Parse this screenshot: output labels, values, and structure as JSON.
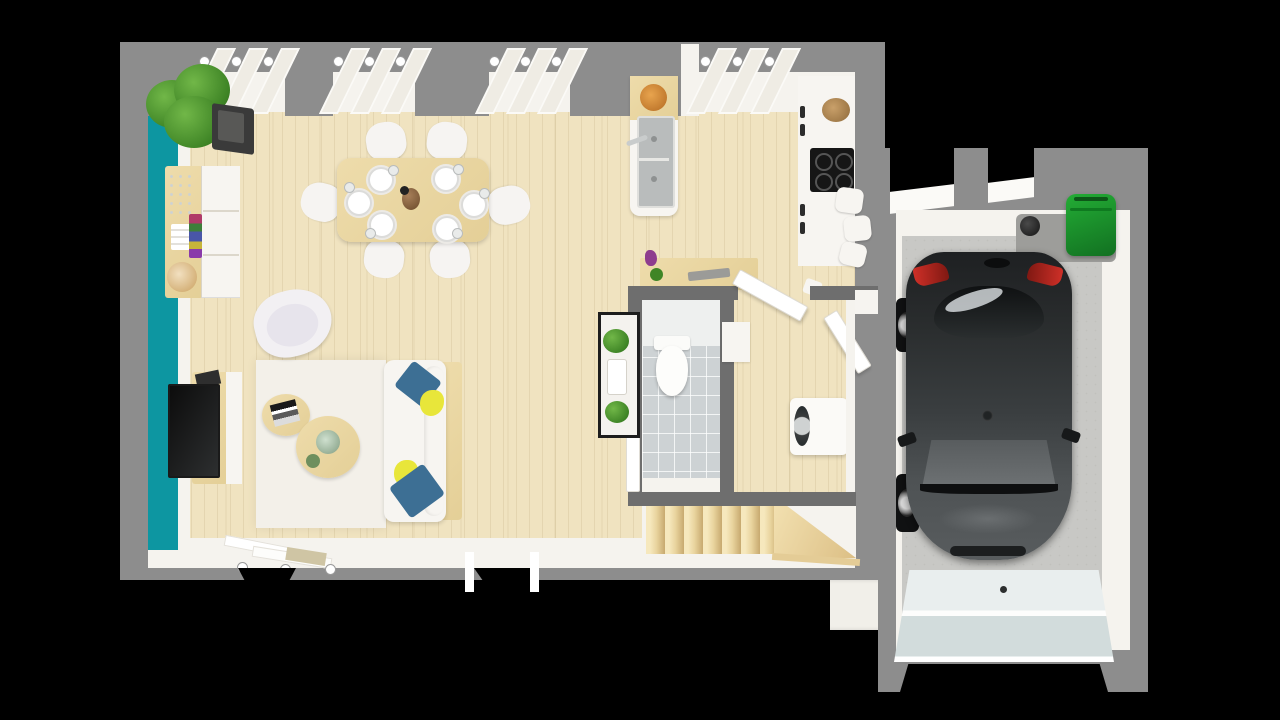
{
  "scene": {
    "type": "3d-floorplan-top-down-render",
    "title": "Ground floor 3D floor plan with attached garage",
    "colors": {
      "background": "#000000",
      "exterior_wall": "#8d8d8d",
      "partition_wall": "#6e6e6e",
      "interior_wall_face": "#f5f3ee",
      "accent_wall_teal": "#0d96a1",
      "wood_floor": "#f0e3c0",
      "stair_wood": "#ecd5a0",
      "furniture_wood": "#e9d8a6",
      "white_furniture": "#f7f5f1",
      "rug": "#f3f0e9",
      "wc_tile": "#cdd2d4",
      "garage_floor": "#c8c8c5",
      "garage_door": "#dde4e4",
      "car_body": "#2a2d2e",
      "car_glass": "#626668",
      "taillight_red": "#c22a22",
      "bin_green": "#1a962b",
      "pillow_blue": "#3d6f94",
      "pillow_yellow": "#e8e63a",
      "plant_green": "#4d9b33",
      "sink_gray": "#b9bcbc",
      "cooktop_black": "#161616"
    },
    "rooms": [
      {
        "id": "living-dining",
        "floor": "light wood planks"
      },
      {
        "id": "kitchen",
        "floor": "light wood planks"
      },
      {
        "id": "wc",
        "floor": "gray tiles"
      },
      {
        "id": "entrance-hall",
        "floor": "light wood planks"
      },
      {
        "id": "staircase",
        "floor": "wood winder stairs"
      },
      {
        "id": "garage",
        "floor": "concrete"
      }
    ],
    "furniture": [
      "potted-plant",
      "wall-clock-box",
      "sideboard-buffet",
      "dining-table",
      "dining-chairs-x6",
      "place-settings-x6",
      "carafe",
      "tv-unit",
      "tv",
      "armchair",
      "rug",
      "round-coffee-table-small",
      "round-coffee-table-large",
      "sofa-with-pillows",
      "kitchen-sink-unit",
      "fruit-bowl",
      "kitchen-counter",
      "cooktop",
      "storage-basket",
      "stools-x3",
      "console-table",
      "plant-shelf",
      "toilet",
      "doormat",
      "washing-machine",
      "open-door-x2",
      "stairs-7-risers",
      "car-hatchback",
      "green-wheelie-bin",
      "spare-wheel",
      "garage-door"
    ],
    "windows": {
      "top_wall_groups": 4,
      "bottom_wall_openings": 2,
      "garage_top_openings": 2
    }
  }
}
